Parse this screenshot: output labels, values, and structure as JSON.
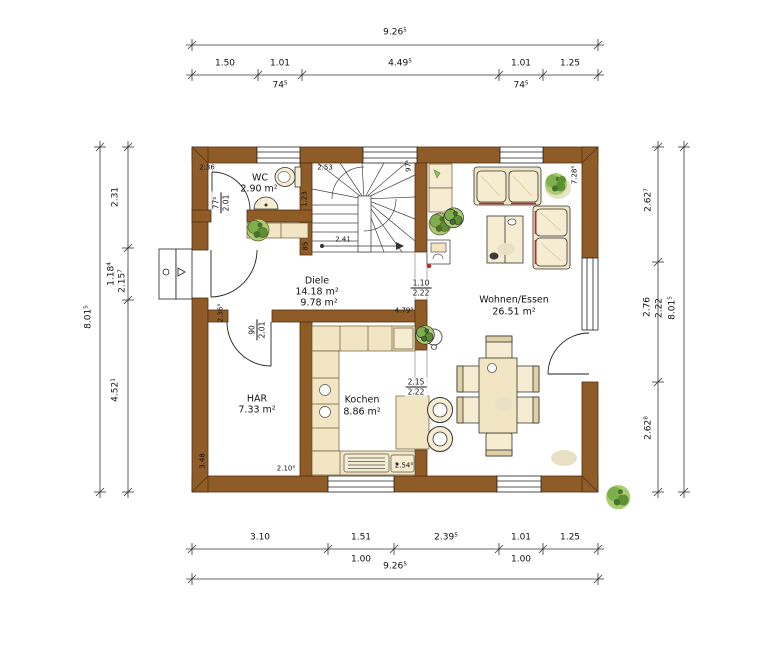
{
  "plan": {
    "rooms": {
      "wc": {
        "name": "WC",
        "area": "2.90 m²"
      },
      "diele": {
        "name": "Diele",
        "area_top": "14.18 m²",
        "area_bottom": "9.78 m²"
      },
      "wohnen_essen": {
        "name": "Wohnen/Essen",
        "area": "26.51 m²"
      },
      "har": {
        "name": "HAR",
        "area": "7.33 m²"
      },
      "kochen": {
        "name": "Kochen",
        "area": "8.86 m²"
      }
    },
    "openings": {
      "wc_door": {
        "width": "77⁵",
        "height": "2.01"
      },
      "har_door": {
        "width": "90",
        "height": "2.01"
      },
      "diele_wohnen": {
        "width": "1.10",
        "height": "2.22"
      },
      "kochen_essen": {
        "width": "2.15",
        "height": "2.22"
      }
    },
    "wall_labels": {
      "wc_top": "2.36",
      "wc_right": "1.23",
      "entry_wall": "2.36⁵",
      "stairs_top": "2.53",
      "stairs_right": "97³",
      "stairs_run": "2.41",
      "diele_stair_wall": "85",
      "har_left": "3.48",
      "har_bottom": "2.10⁵",
      "kochen_bottom": "2.54⁵",
      "diele_right": "4.79⁵",
      "wohnen_right": "7.28⁵"
    }
  },
  "dimensions": {
    "top": {
      "total": "9.26⁵",
      "segments": [
        "1.50",
        "1.01",
        "4.49⁵",
        "1.01",
        "1.25"
      ],
      "sub_left": "74⁵",
      "sub_right": "74⁵"
    },
    "bottom": {
      "total": "9.26⁵",
      "segments": [
        "3.10",
        "1.51",
        "2.39⁵",
        "1.01",
        "1.25"
      ],
      "sub_left": "1.00",
      "sub_right": "1.00"
    },
    "left": {
      "total": "8.01⁵",
      "segments": [
        "2.31",
        "1.18⁴",
        "4.52¹"
      ],
      "inner": "2.15⁷"
    },
    "right": {
      "total": "8.01⁵",
      "segments": [
        "2.62⁷",
        "2.76",
        "2.62⁸"
      ],
      "inner": "2.22"
    }
  },
  "colors": {
    "wall": "#8f5c28",
    "furniture": "#f1e5c3",
    "accent_red": "#cc2222",
    "plant_green": "#7daf4a"
  }
}
